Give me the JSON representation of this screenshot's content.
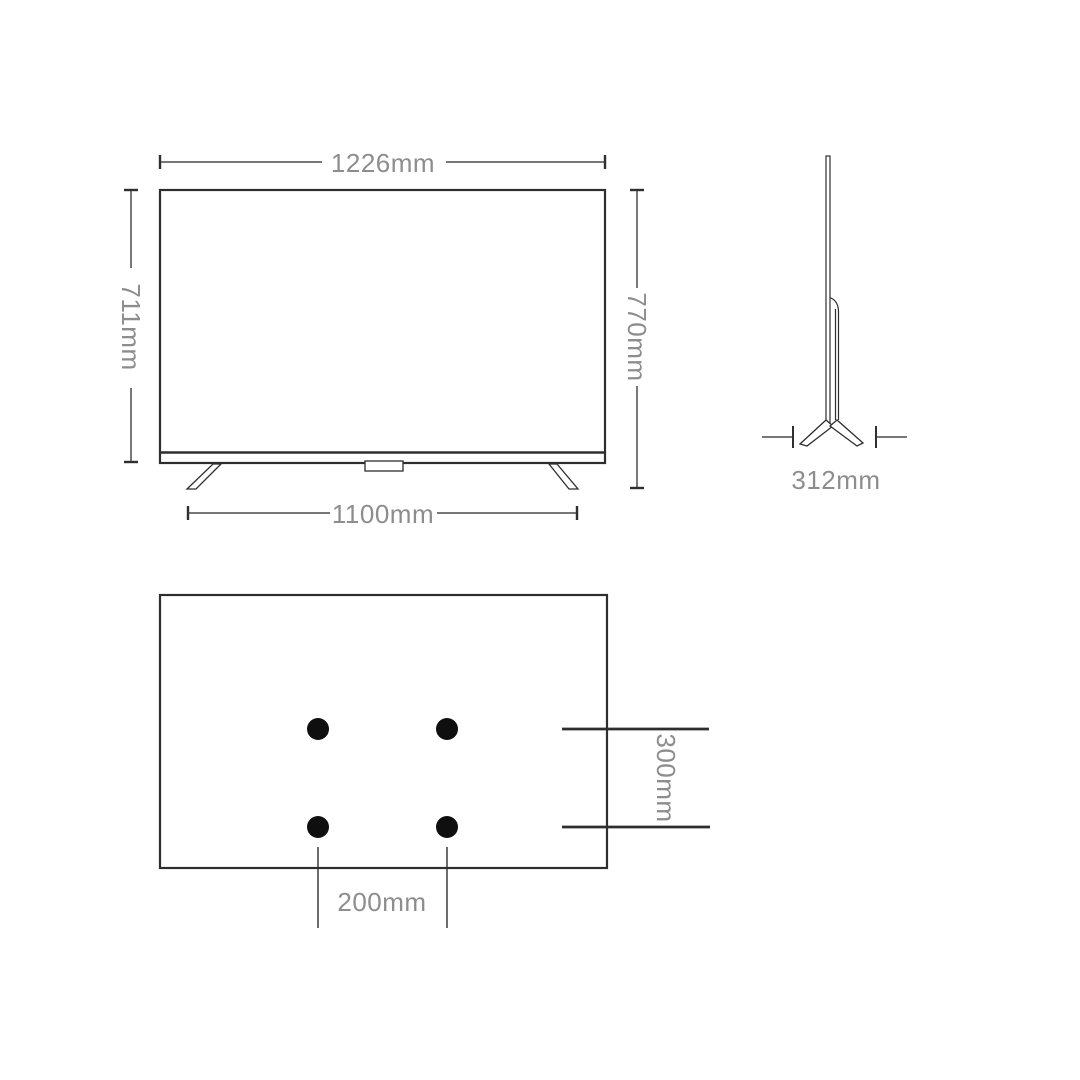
{
  "front_view": {
    "width_label": "1226mm",
    "panel_height_label": "711mm",
    "total_height_label": "770mm",
    "stand_width_label": "1100mm"
  },
  "side_view": {
    "depth_label": "312mm"
  },
  "back_view": {
    "vesa_vertical_label": "300mm",
    "vesa_horizontal_label": "200mm",
    "mount_hole_count": 4
  },
  "colors": {
    "background": "#ffffff",
    "outline": "#2e2e2e",
    "dimension_line": "#4a4a4a",
    "label_text": "#8d8d8d",
    "mount_hole": "#0f0f0f"
  }
}
